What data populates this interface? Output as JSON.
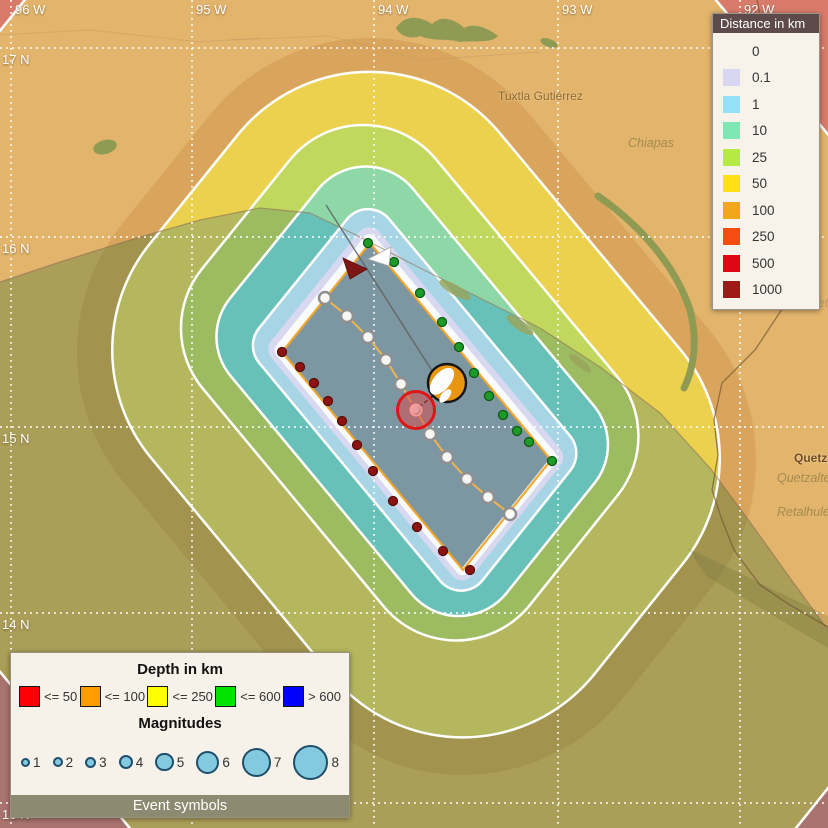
{
  "map": {
    "bg_land": "#e2b46c",
    "ocean_clip": "M0,282 L60,262 L130,240 L200,220 L260,208 L310,213 L360,237 L420,268 L480,298 L540,328 L600,367 L660,413 L710,468 L750,522 L790,578 L828,630 L828,828 L0,828 Z",
    "coast_line": "M0,282 L60,262 L130,240 L200,220 L260,208 L310,213 L360,237 L420,268 L480,298 L540,328 L600,367 L660,413 L710,468 L750,522 L790,578 L828,630",
    "coast_color": "#8a6a48",
    "fault": {
      "corners": [
        [
          370,
          243
        ],
        [
          551,
          460
        ],
        [
          463,
          570
        ],
        [
          282,
          352
        ]
      ],
      "fill": "#7c97a2",
      "edge_color": "#f4a524",
      "center_line_color": "#f2b24e"
    },
    "bands": [
      {
        "label": "250",
        "margin": 560,
        "shift": 0,
        "land": "#d87b6b",
        "ocean": "#a9746f",
        "rim": false
      },
      {
        "label": "100",
        "margin": 420,
        "shift": 0,
        "land": "#e2b46c",
        "ocean": "#ab9e58",
        "rim": true
      },
      {
        "label": "100-shade",
        "margin": 205,
        "shift": 0,
        "land": "#d9a55c",
        "ocean": "#a2944f",
        "rim": false
      },
      {
        "label": "50",
        "margin": 168,
        "shift": 2,
        "land": "#ecd14f",
        "ocean": "#b5b75e",
        "rim": true
      },
      {
        "label": "25",
        "margin": 93,
        "shift": 25,
        "land": "#c2d75e",
        "ocean": "#9dbc62",
        "rim": true
      },
      {
        "label": "10",
        "margin": 60,
        "shift": 16,
        "land": "#8ed7a7",
        "ocean": "#68c1b8",
        "rim": true
      }
    ],
    "inner_bands": [
      {
        "label": "1",
        "margin": 26,
        "shift": 7,
        "color": "#a8d5e6",
        "rim": true
      },
      {
        "label": "0.1",
        "margin": 13,
        "shift": 3,
        "color": "#d8d8f0",
        "rim": false
      },
      {
        "label": "0",
        "margin": 7,
        "shift": 2,
        "color": "#fafbfd",
        "rim": false
      }
    ],
    "grid": {
      "color": "#ffffff",
      "meridians": [
        {
          "label": "96 W",
          "x": 11
        },
        {
          "label": "95 W",
          "x": 192
        },
        {
          "label": "94 W",
          "x": 374
        },
        {
          "label": "93 W",
          "x": 558
        },
        {
          "label": "92 W",
          "x": 740
        }
      ],
      "parallels": [
        {
          "label": "17 N",
          "y": 48
        },
        {
          "label": "16 N",
          "y": 237
        },
        {
          "label": "15 N",
          "y": 427
        },
        {
          "label": "14 N",
          "y": 613
        },
        {
          "label": "13 N",
          "y": 803
        }
      ]
    },
    "labels": [
      {
        "id": "tuxtla-gutierrez",
        "text": "Tuxtla Gutiérrez",
        "x": 498,
        "y": 89,
        "style": "city"
      },
      {
        "id": "chiapas",
        "text": "Chiapas",
        "x": 628,
        "y": 136,
        "style": "region"
      },
      {
        "id": "quetzaltenango-city",
        "text": "Quetzaltenango",
        "x": 794,
        "y": 451,
        "style": "city-bold"
      },
      {
        "id": "quetzaltenango-region",
        "text": "Quetzaltenango",
        "x": 777,
        "y": 471,
        "style": "region"
      },
      {
        "id": "retalhuleu",
        "text": "Retalhuleu",
        "x": 777,
        "y": 505,
        "style": "region"
      },
      {
        "id": "huehuetenango",
        "text": "Huehuetenango",
        "x": 781,
        "y": 296,
        "style": "region-lt"
      }
    ],
    "lakes": {
      "color": "#8f9b52",
      "blobs": [
        "M396,28 C405,14 420,16 432,24 C442,14 456,20 464,28 C474,22 488,28 498,36 C490,44 474,40 460,42 C448,38 434,42 420,36 C410,40 399,35 396,28 Z"
      ],
      "strokes": [
        "M598,196 C640,225 675,265 690,310 C698,340 694,368 684,388"
      ],
      "ellipses": [
        {
          "x": 549,
          "y": 43,
          "rx": 9,
          "ry": 4,
          "rot": 20
        },
        {
          "x": 105,
          "y": 147,
          "rx": 12,
          "ry": 7,
          "rot": -15
        }
      ]
    },
    "spits": [
      {
        "x": 455,
        "y": 290,
        "rx": 18,
        "ry": 5,
        "rot": 30
      },
      {
        "x": 520,
        "y": 325,
        "rx": 16,
        "ry": 5,
        "rot": 35
      },
      {
        "x": 580,
        "y": 363,
        "rx": 14,
        "ry": 4,
        "rot": 38
      }
    ],
    "borders": {
      "color": "#7a5a38",
      "paths": [
        "M757,0 L772,70 L795,150 L800,230 L788,300 L755,350 L722,383 L714,420 L718,455 L712,490 L722,520 L734,550 L760,585 L790,605 L828,627"
      ],
      "faint": [
        "M0,35 L90,30 L200,42 L260,38",
        "M230,40 L330,36 L420,60 L540,52"
      ]
    },
    "hillshade": "688,548 828,616 828,648 706,576",
    "dots": {
      "green": {
        "r": 4.5,
        "fill": "#1d9b28",
        "stroke": "#0e5a14",
        "points": [
          [
            368,
            243
          ],
          [
            394,
            262
          ],
          [
            420,
            293
          ],
          [
            442,
            322
          ],
          [
            459,
            347
          ],
          [
            474,
            373
          ],
          [
            489,
            396
          ],
          [
            503,
            415
          ],
          [
            517,
            431
          ],
          [
            529,
            442
          ],
          [
            552,
            461
          ]
        ]
      },
      "red": {
        "r": 4.5,
        "fill": "#8e1310",
        "stroke": "#55100c",
        "points": [
          [
            282,
            352
          ],
          [
            300,
            367
          ],
          [
            314,
            383
          ],
          [
            328,
            401
          ],
          [
            342,
            421
          ],
          [
            357,
            445
          ],
          [
            373,
            471
          ],
          [
            393,
            501
          ],
          [
            417,
            527
          ],
          [
            443,
            551
          ],
          [
            470,
            570
          ]
        ]
      },
      "gray": {
        "r": 6,
        "fill": "#ffffff",
        "stroke": "#909090",
        "points": [
          [
            325,
            298
          ],
          [
            347,
            316
          ],
          [
            368,
            337
          ],
          [
            386,
            360
          ],
          [
            401,
            384
          ],
          [
            415,
            409
          ],
          [
            430,
            434
          ],
          [
            447,
            457
          ],
          [
            467,
            479
          ],
          [
            488,
            497
          ],
          [
            510,
            514
          ]
        ]
      }
    },
    "markers": {
      "azimuth_line": {
        "points": "326,205 445,391",
        "color": "#5f5f5f"
      },
      "needle": {
        "points": "433,396 419,407",
        "color": "#222222"
      },
      "triangle_white": {
        "points": "368,259 391,247 389,266",
        "fill": "#ffffff",
        "stroke": "#aaaaaa"
      },
      "triangle_red": {
        "points": "343,258 350,279 367,269",
        "fill": "#7d1614",
        "stroke": "#5a100e"
      },
      "beachball": {
        "x": 447,
        "y": 383,
        "r": 19,
        "fill": "#e8950f",
        "stroke": "#141414"
      },
      "epicenter": {
        "x": 416,
        "y": 410,
        "r": 18.5,
        "fill": "rgba(222,70,70,0.5)",
        "stroke": "#e01616"
      }
    }
  },
  "distance_legend": {
    "title": "Distance in km",
    "items": [
      {
        "label": "0",
        "color": ""
      },
      {
        "label": "0.1",
        "color": "#d8d6f0"
      },
      {
        "label": "1",
        "color": "#93e0f8"
      },
      {
        "label": "10",
        "color": "#7de8b4"
      },
      {
        "label": "25",
        "color": "#b5e943"
      },
      {
        "label": "50",
        "color": "#ffe014"
      },
      {
        "label": "100",
        "color": "#f2a71b"
      },
      {
        "label": "250",
        "color": "#f44d0f"
      },
      {
        "label": "500",
        "color": "#e00613"
      },
      {
        "label": "1000",
        "color": "#a01916"
      }
    ]
  },
  "event_panel": {
    "depth_title": "Depth in km",
    "depth_items": [
      {
        "label": "<= 50",
        "color": "#fe0000"
      },
      {
        "label": "<= 100",
        "color": "#ff9c00"
      },
      {
        "label": "<= 250",
        "color": "#ffff00"
      },
      {
        "label": "<= 600",
        "color": "#00e400"
      },
      {
        "label": "> 600",
        "color": "#0000fe"
      }
    ],
    "magnitudes_title": "Magnitudes",
    "magnitudes": [
      {
        "label": "1",
        "d": 9
      },
      {
        "label": "2",
        "d": 10
      },
      {
        "label": "3",
        "d": 11
      },
      {
        "label": "4",
        "d": 14
      },
      {
        "label": "5",
        "d": 18.5
      },
      {
        "label": "6",
        "d": 23
      },
      {
        "label": "7",
        "d": 29
      },
      {
        "label": "8",
        "d": 35
      }
    ],
    "mag_fill": "#84cade",
    "mag_stroke": "#1d4e6b",
    "footer": "Event symbols"
  }
}
